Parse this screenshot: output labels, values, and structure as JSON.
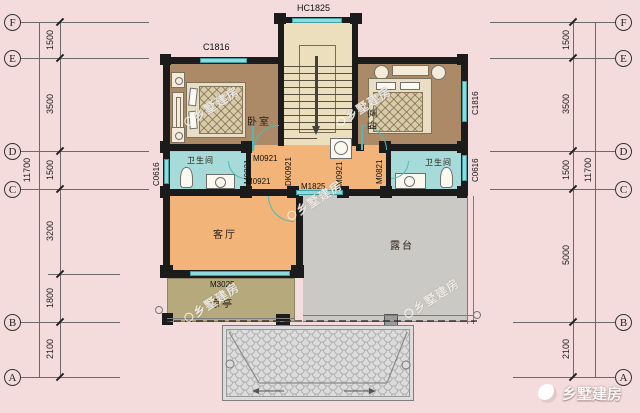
{
  "meta": {
    "watermark": "乡墅建房"
  },
  "grid": {
    "rows": [
      "F",
      "E",
      "D",
      "C",
      "B",
      "A"
    ]
  },
  "dimensions": {
    "left": [
      "1500",
      "3500",
      "1500",
      "3200",
      "1800",
      "2100"
    ],
    "left_total": "11700",
    "right": [
      "1500",
      "3500",
      "1500",
      "5000",
      "2100"
    ],
    "right_total": "11700"
  },
  "rooms": {
    "bedroom_left": "卧室",
    "bedroom_right": "卧室",
    "bathroom_left": "卫生间",
    "bathroom_right": "卫生间",
    "living_room": "客厅",
    "terrace": "露台",
    "pavilion": "凉亭"
  },
  "openings": {
    "stair_window": "HC1825",
    "bedroom_left_window": "C1816",
    "bedroom_right_window": "C1816",
    "bathroom_left_window": "C0616",
    "bathroom_right_window": "C0616",
    "left_bath_door": "M0821",
    "left_bedroom_door": "M0921",
    "left_hall_door": "M0921",
    "stair_opening": "DK0921",
    "right_bedroom_door": "M0921",
    "right_bath_door": "M0821",
    "terrace_door": "M1825",
    "pavilion_opening": "M3025"
  }
}
